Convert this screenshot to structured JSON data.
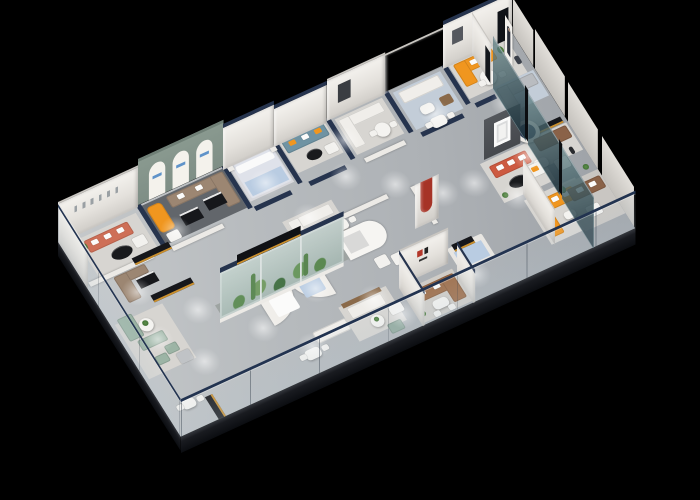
{
  "scene": {
    "type": "3d-isometric-floorplan-render",
    "description": "Isometric dollhouse cutaway render of a furniture showroom floor plan on a black background, with glass balustrade edges, navy-capped white partition walls, a planted glass terrarium case, and many furnished room vignettes.",
    "background": "black",
    "visible_text": "none (signage and wall logos are illegible at this scale)"
  },
  "palette": {
    "bg": "#000000",
    "floor": "#b4b8bb",
    "slab-edge": "#14171c",
    "wall-white": "#ece9e4",
    "wall-cap-navy": "#26344e",
    "sage-wall": "#7e8e85",
    "arch-ivory": "#f4f2ec",
    "glass-clear": "#c9d7e0",
    "glass-tint-dark": "#2e4a54",
    "rail-navy": "#223350",
    "rug-light": "#d7d5d1",
    "rug-dark": "#62666b",
    "rug-blue": "#c3cdd8",
    "counter-black": "#16171b",
    "counter-amber": "#c98f2e",
    "coral-sofa": "#ce6f57",
    "orange-sofa": "#f0961f",
    "taupe-sofa": "#9c8672",
    "teal-sofa": "#6f93a3",
    "sage-sofa": "#9cb4a5",
    "brown-leather": "#9c6a45",
    "red-sofa": "#cd5a41",
    "red-accent": "#a63326",
    "charcoal-wall": "#46494e",
    "pale-blue": "#b9cce2",
    "cream-white": "#efede9",
    "plant-green": "#5d8f4a",
    "wood": "#8a6a4a"
  },
  "inventory": {
    "perimeter": [
      {
        "name": "southwest-glass-balustrade",
        "material": "clear glass, navy top rail"
      },
      {
        "name": "southeast-glass-balustrade",
        "material": "clear glass, navy top rail"
      },
      {
        "name": "northeast-tinted-glass-partitions",
        "material": "dark teal tinted glass, 3 panels"
      },
      {
        "name": "floor-slab-edge",
        "material": "dark charcoal"
      }
    ],
    "rooms": [
      {
        "name": "coral-sofa-room",
        "items": [
          "coral striped sofa with white cushions",
          "black oval coffee table",
          "wall art strip"
        ]
      },
      {
        "name": "arched-window-room",
        "items": [
          "sage green wall with three ivory arches",
          "orange chaise",
          "taupe sectional",
          "two black display tables",
          "dark gray rug"
        ]
      },
      {
        "name": "bedroom-display",
        "items": [
          "pale blue bed with white pillows",
          "nightstands"
        ]
      },
      {
        "name": "teal-sofa-lounge",
        "items": [
          "teal sofa with orange pillows",
          "black round table"
        ]
      },
      {
        "name": "white-sectional-room",
        "items": [
          "white L sofa",
          "round glass dining table"
        ]
      },
      {
        "name": "slat-wall-room",
        "items": [
          "white sofa",
          "wood chair",
          "coffee table"
        ]
      },
      {
        "name": "north-corner-room",
        "items": [
          "orange L sofa",
          "round dining table",
          "greeter cutout figure"
        ]
      },
      {
        "name": "terrarium-display",
        "items": [
          "glass case with cacti and plants",
          "navy top band",
          "black media beam"
        ]
      },
      {
        "name": "alcove-beds",
        "items": [
          "curved white half walls",
          "white bed",
          "blue bed",
          "canopy daybed"
        ]
      },
      {
        "name": "tv-feature-room",
        "items": [
          "charcoal media wall with blank white screen",
          "red sofa with white pillows",
          "black oval table",
          "navy disc on white cylinder"
        ]
      },
      {
        "name": "red-arch-feature",
        "items": [
          "white wall with curved red band"
        ]
      },
      {
        "name": "brand-logo-room",
        "items": [
          "white logo wall with red and black marks",
          "cognac leather sectional",
          "white dining set"
        ]
      },
      {
        "name": "orange-sectional-room",
        "items": [
          "bright orange L sofa with white pillows"
        ]
      },
      {
        "name": "glass-front-rooms",
        "items": [
          "gray sofa set",
          "brown sofa",
          "white armchair",
          "media console"
        ]
      },
      {
        "name": "southwest-lounge",
        "items": [
          "sage green sectional and ottomans",
          "white round table with plant",
          "taupe sofa",
          "black retail counters with amber edge",
          "dining sets"
        ]
      },
      {
        "name": "cream-lounge",
        "items": [
          "cream sofa",
          "wood console",
          "round coffee table",
          "sage ottoman",
          "blue platform bed"
        ]
      }
    ],
    "lighting": "recessed ceiling downlights casting soft elliptical glow pools on the floor"
  }
}
